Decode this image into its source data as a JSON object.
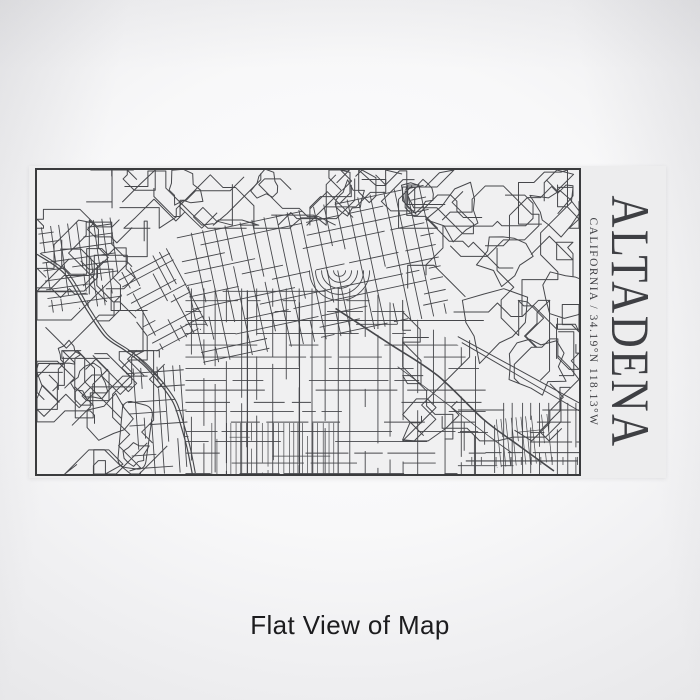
{
  "label": {
    "title": "ALTADENA",
    "subtitle": "CALIFORNIA / 34.19°N 118.13°W"
  },
  "caption": {
    "text": "Flat View of Map"
  },
  "colors": {
    "map_line": "#46474b",
    "map_frame_border": "#3a3b3d",
    "label_background": "#ededee",
    "map_background": "#f0f0f1",
    "title_text": "#3e3f43",
    "caption_text": "#1c1c1e"
  }
}
